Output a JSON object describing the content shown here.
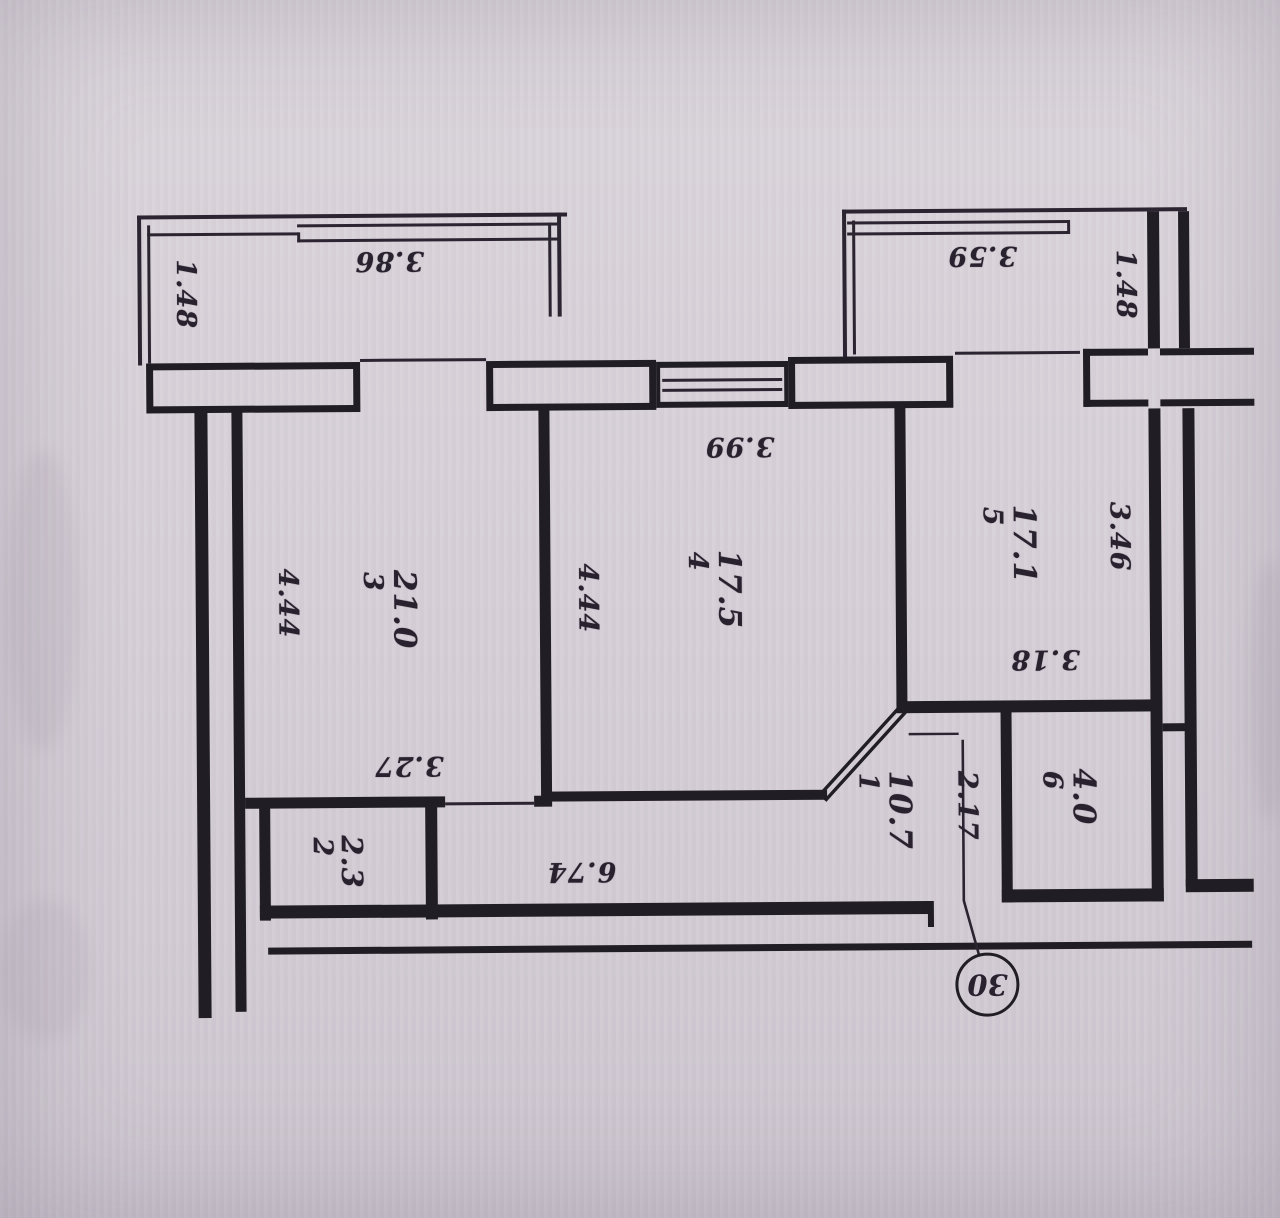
{
  "plan": {
    "apartment_number": "30",
    "balconies": {
      "left": {
        "width": "3.86",
        "depth": "1.48"
      },
      "right": {
        "width": "3.59",
        "depth": "1.48"
      }
    },
    "rooms": {
      "r1": {
        "number": "1",
        "area": "10.7"
      },
      "r2": {
        "number": "2",
        "area": "2.3"
      },
      "r3": {
        "number": "3",
        "area": "21.0"
      },
      "r4": {
        "number": "4",
        "area": "17.5"
      },
      "r5": {
        "number": "5",
        "area": "17.1"
      },
      "r6": {
        "number": "6",
        "area": "4.0"
      }
    },
    "dims": {
      "r3_left": "4.44",
      "r3_bottom": "3.27",
      "r4_left": "4.44",
      "r4_top": "3.99",
      "r5_right": "3.46",
      "r5_bottom": "3.18",
      "hall_width": "2.17",
      "corridor_length": "6.74"
    }
  }
}
